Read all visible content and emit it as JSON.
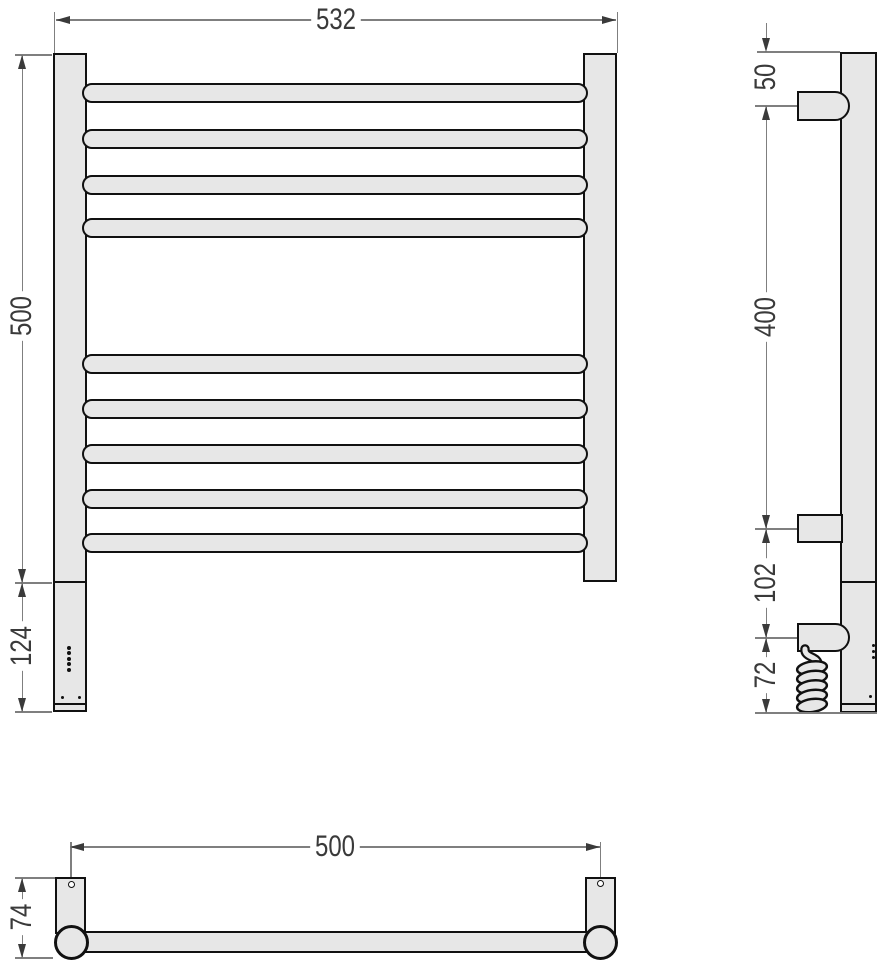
{
  "drawing": {
    "front_view": {
      "width": "532",
      "height": "500",
      "heater_section": "124",
      "bar_count": 9
    },
    "side_view": {
      "top_offset": "50",
      "bracket_span": "400",
      "bracket_to_terminal": "102",
      "cable_drop": "72"
    },
    "bottom_view": {
      "mount_centers": "500",
      "depth": "74"
    },
    "colors": {
      "body_fill": "#e7e7e7",
      "outline": "#111111",
      "dim_line": "#7f7f7f",
      "dim_text": "#3a3a3a"
    }
  }
}
